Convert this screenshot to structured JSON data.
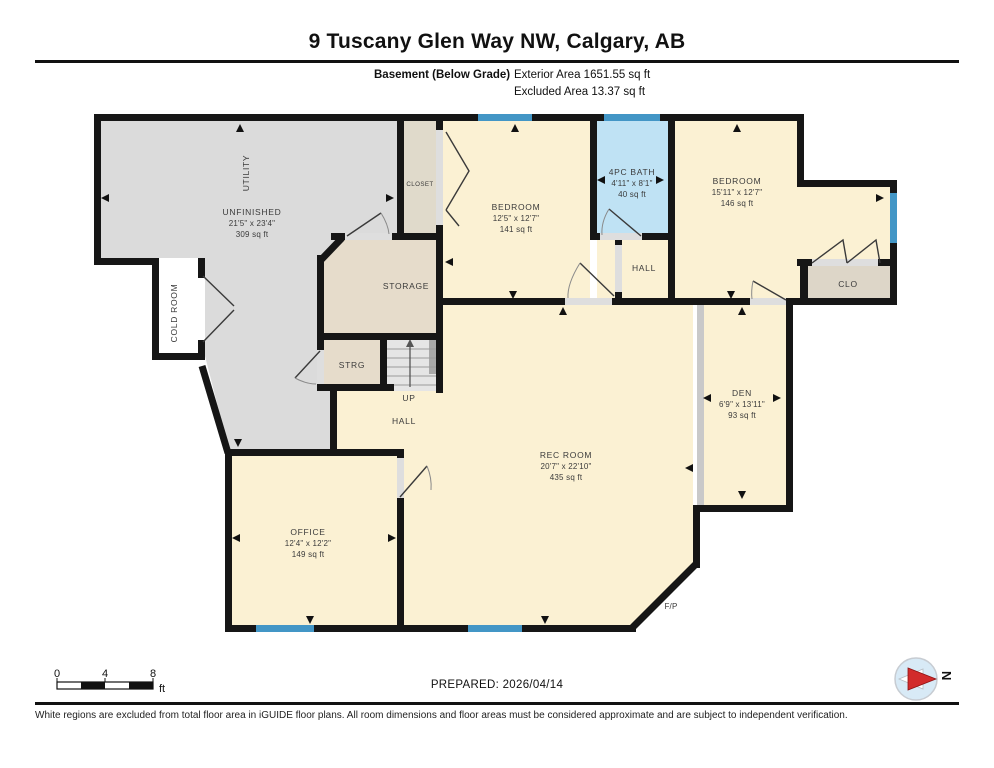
{
  "header": {
    "title": "9 Tuscany Glen Way NW, Calgary, AB",
    "floor_label": "Basement (Below Grade)",
    "exterior_area": "Exterior Area 1651.55 sq ft",
    "excluded_area": "Excluded Area 13.37 sq ft"
  },
  "rooms": {
    "utility": {
      "name": "UTILITY"
    },
    "unfinished": {
      "name": "UNFINISHED",
      "dims": "21'5\" x 23'4\"",
      "area": "309 sq ft"
    },
    "cold_room": {
      "name": "COLD ROOM"
    },
    "closet": {
      "name": "CLOSET"
    },
    "bedroom1": {
      "name": "BEDROOM",
      "dims": "12'5\" x 12'7\"",
      "area": "141 sq ft"
    },
    "bath": {
      "name": "4PC BATH",
      "dims": "4'11\" x 8'1\"",
      "area": "40 sq ft"
    },
    "bedroom2": {
      "name": "BEDROOM",
      "dims": "15'11\" x 12'7\"",
      "area": "146 sq ft"
    },
    "clo": {
      "name": "CLO"
    },
    "hall_upper": {
      "name": "HALL"
    },
    "storage": {
      "name": "STORAGE"
    },
    "strg": {
      "name": "STRG"
    },
    "up": {
      "name": "UP"
    },
    "hall_lower": {
      "name": "HALL"
    },
    "rec_room": {
      "name": "REC ROOM",
      "dims": "20'7\" x 22'10\"",
      "area": "435 sq ft"
    },
    "den": {
      "name": "DEN",
      "dims": "6'9\" x 13'11\"",
      "area": "93 sq ft"
    },
    "office": {
      "name": "OFFICE",
      "dims": "12'4\" x 12'2\"",
      "area": "149 sq ft"
    },
    "fireplace": {
      "name": "F/P"
    }
  },
  "footer": {
    "scale": {
      "t0": "0",
      "t4": "4",
      "t8": "8",
      "unit": "ft"
    },
    "prepared": "PREPARED: 2026/04/14",
    "compass_n": "N",
    "disclaimer": "White regions are excluded from total floor area in iGUIDE floor plans. All room dimensions and floor areas must be considered approximate and are subject to independent verification."
  },
  "colors": {
    "wall": "#161616",
    "room_yellow": "#FBF1D3",
    "room_gray": "#DBDBDB",
    "room_beige": "#E6DCCB",
    "bath_blue": "#BFE2F4",
    "window_blue": "#4396C6",
    "compass_red": "#D22B2B"
  }
}
